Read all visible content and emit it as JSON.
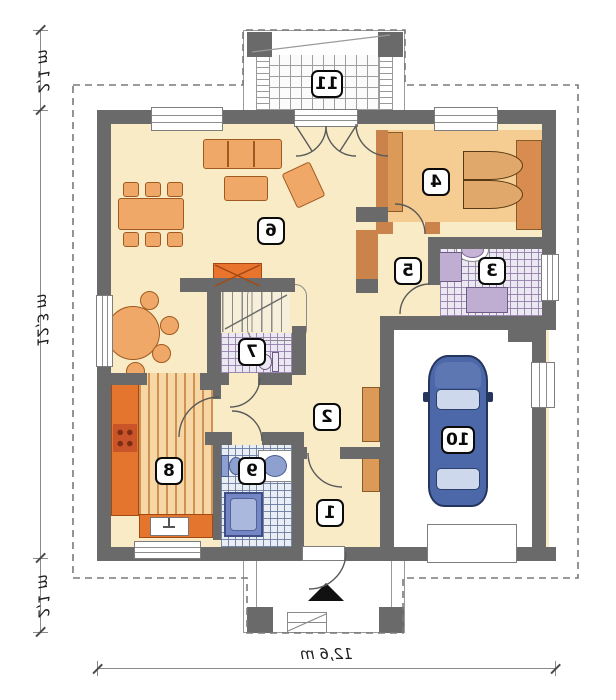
{
  "rooms": [
    {
      "number": "1"
    },
    {
      "number": "2"
    },
    {
      "number": "3"
    },
    {
      "number": "4"
    },
    {
      "number": "5"
    },
    {
      "number": "6"
    },
    {
      "number": "7"
    },
    {
      "number": "8"
    },
    {
      "number": "9"
    },
    {
      "number": "10"
    },
    {
      "number": "11"
    }
  ],
  "dimensions": {
    "left_top": "2,1 m",
    "left_middle": "12,3 m",
    "left_bottom": "2,1 m",
    "bottom": "12,6 m"
  },
  "colors": {
    "wall": "#6a6a6a",
    "partition": "#c9834b",
    "floor_cream": "#f8ebc6",
    "floor_bedroom": "#f5cd92",
    "kitchen_counter": "#e4752f",
    "fireplace": "#e8742e",
    "tile_lilac": "#8f7aa8",
    "tile_blue": "#6c7ca0",
    "car_body": "#4c68a8",
    "shower": "#7487c4"
  }
}
